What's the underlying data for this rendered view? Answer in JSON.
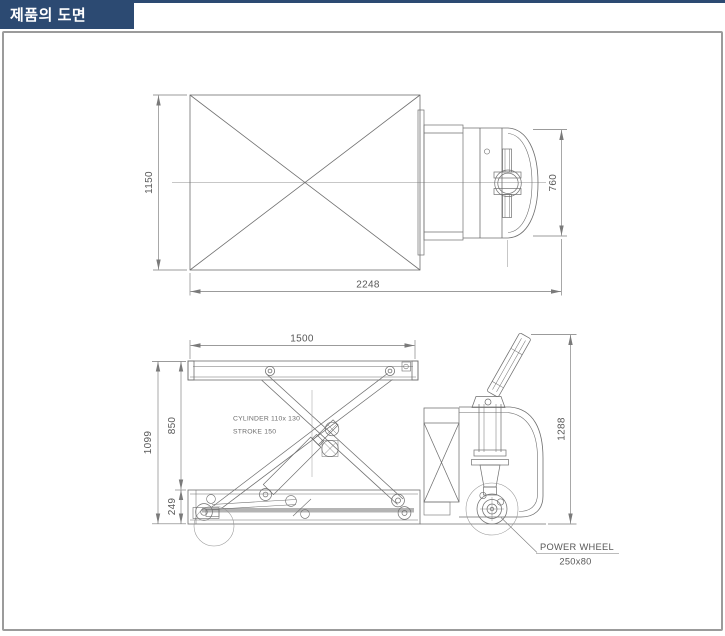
{
  "header": {
    "title": "제품의 도면",
    "bg_color": "#2c4a72",
    "text_color": "#ffffff"
  },
  "frame": {
    "border_color": "#9b9b9b"
  },
  "drawing": {
    "line_color": "#6f6f6f",
    "thin_color": "#8f8f8f",
    "dim_color": "#7a7a7a",
    "text_color": "#585858",
    "views": {
      "top_view": {
        "name": "top view (plan) of lift platform and power unit",
        "dims": {
          "platform_width": "1150",
          "body_width": "760",
          "overall_length": "2248"
        }
      },
      "side_view": {
        "name": "side view (elevation) of scissor lift truck",
        "dims": {
          "platform_length": "1500",
          "raised_height": "850",
          "overall_height": "1099",
          "lowered_height": "249",
          "handle_height": "1288"
        },
        "annotations": {
          "cylinder_line1": "CYLINDER  110x 130",
          "cylinder_line2": "STROKE 150",
          "power_wheel_label": "POWER WHEEL",
          "power_wheel_size": "250x80"
        }
      }
    }
  }
}
